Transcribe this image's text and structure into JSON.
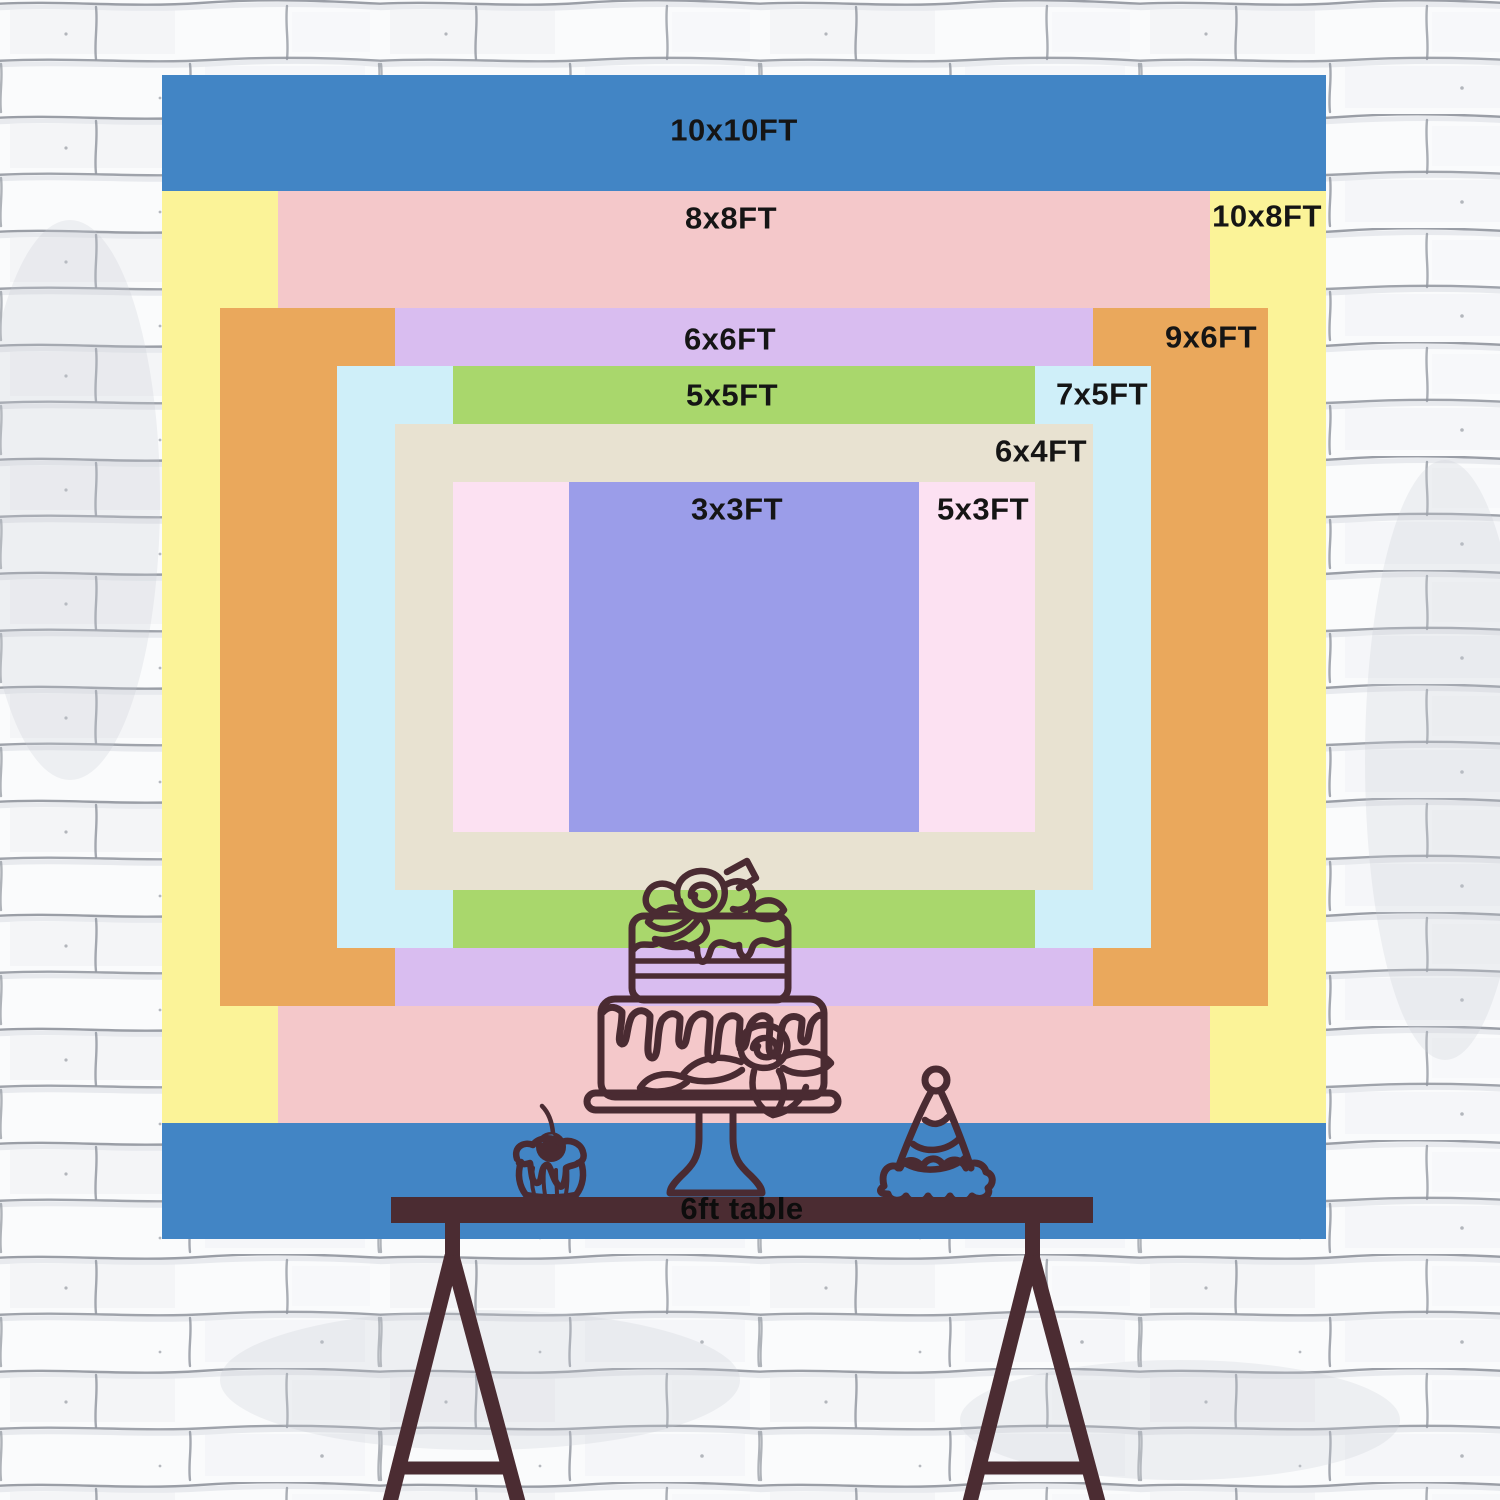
{
  "size_chart": {
    "unit": "FT",
    "layers": [
      {
        "id": "10x10",
        "label": "10x10FT",
        "width_ft": 10,
        "height_ft": 10,
        "color": "#4285c5",
        "label_x": 734,
        "label_y": 130
      },
      {
        "id": "10x8",
        "label": "10x8FT",
        "width_ft": 10,
        "height_ft": 8,
        "color": "#fbf398",
        "label_x": 1267,
        "label_y": 216
      },
      {
        "id": "8x8",
        "label": "8x8FT",
        "width_ft": 8,
        "height_ft": 8,
        "color": "#f4c8ca",
        "label_x": 731,
        "label_y": 218
      },
      {
        "id": "9x6",
        "label": "9x6FT",
        "width_ft": 9,
        "height_ft": 6,
        "color": "#eaa85c",
        "label_x": 1211,
        "label_y": 337
      },
      {
        "id": "6x6",
        "label": "6x6FT",
        "width_ft": 6,
        "height_ft": 6,
        "color": "#d9bdf0",
        "label_x": 730,
        "label_y": 339
      },
      {
        "id": "7x5",
        "label": "7x5FT",
        "width_ft": 7,
        "height_ft": 5,
        "color": "#cfeff9",
        "label_x": 1102,
        "label_y": 394
      },
      {
        "id": "5x5",
        "label": "5x5FT",
        "width_ft": 5,
        "height_ft": 5,
        "color": "#a9d76c",
        "label_x": 732,
        "label_y": 395
      },
      {
        "id": "6x4",
        "label": "6x4FT",
        "width_ft": 6,
        "height_ft": 4,
        "color": "#e8e2d1",
        "label_x": 1041,
        "label_y": 451
      },
      {
        "id": "5x3",
        "label": "5x3FT",
        "width_ft": 5,
        "height_ft": 3,
        "color": "#fce1f2",
        "label_x": 983,
        "label_y": 509
      },
      {
        "id": "3x3",
        "label": "3x3FT",
        "width_ft": 3,
        "height_ft": 3,
        "color": "#9b9de9",
        "label_x": 737,
        "label_y": 509
      }
    ]
  },
  "table": {
    "label": "6ft table",
    "color": "#4b2c32"
  },
  "decor": {
    "outline_color": "#4a2b32",
    "items": [
      "birthday-cake-icon",
      "cupcake-icon",
      "party-hat-icon"
    ]
  },
  "text_color": "#151515"
}
